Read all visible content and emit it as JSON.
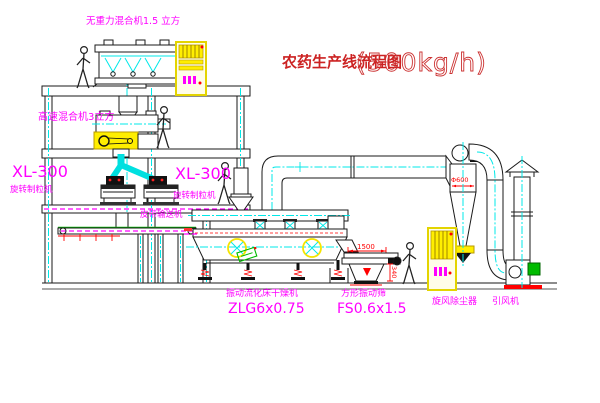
{
  "title": {
    "name": "农药生产线流程图",
    "capacity": "(500kg/h)"
  },
  "equipment_labels": {
    "gravity_free_mixer": "无重力混合机1.5 立方",
    "high_speed_mixer": "高速混合机3立方",
    "granulator_left_model": "XL-300",
    "granulator_left_name": "旋转制粒机",
    "granulator_right_model": "XL-300",
    "granulator_right_name": "旋转制粒机",
    "belt_conveyor": "皮带输送机",
    "fluid_bed_dryer_name": "振动流化床干燥机",
    "fluid_bed_dryer_model": "ZLG6x0.75",
    "vibrating_sieve_name": "方形振动筛",
    "vibrating_sieve_model": "FS0.6x1.5",
    "cyclone_dust_collector": "旋风除尘器",
    "induced_draft_fan": "引风机"
  },
  "dimensions": {
    "cyclone_diameter": "Φ600",
    "sieve_length": "1500",
    "sieve_height": "340"
  },
  "colors": {
    "label_magenta": "#ff00ff",
    "centerline_cyan": "#00e8e8",
    "dimension_red": "#ff0000",
    "highlight_yellow": "#f5e400",
    "accent_green": "#00bb00",
    "title_red": "#cc2222",
    "line_black": "#1a1a1a",
    "background": "#ffffff"
  }
}
